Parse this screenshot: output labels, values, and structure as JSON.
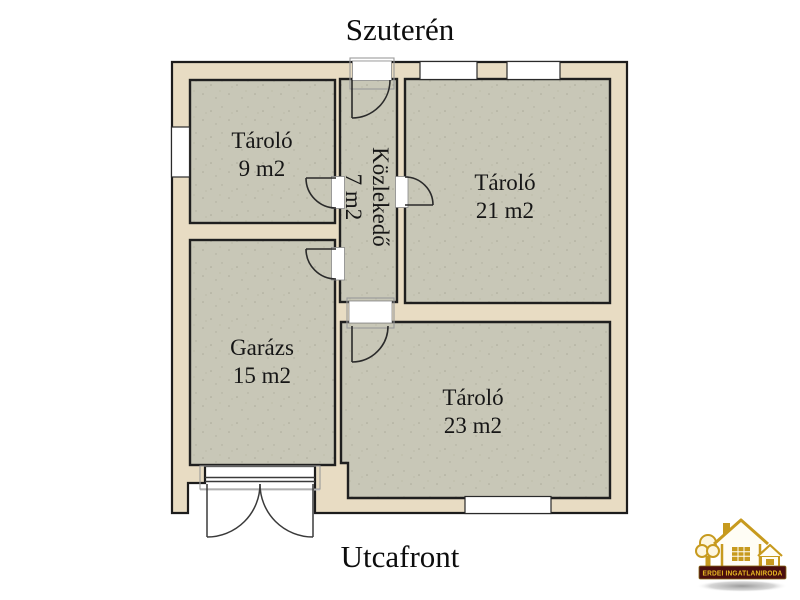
{
  "titles": {
    "top": "Szuterén",
    "bottom": "Utcafront"
  },
  "rooms": [
    {
      "name": "Tároló",
      "area": "9 m2"
    },
    {
      "name": "Közlekedő",
      "area": "7 m2"
    },
    {
      "name": "Tároló",
      "area": "21 m2"
    },
    {
      "name": "Garázs",
      "area": "15 m2"
    },
    {
      "name": "Tároló",
      "area": "23 m2"
    }
  ],
  "logo": {
    "banner": "ERDEI INGATLANIRODA"
  },
  "colors": {
    "wall_fill": "#e8dcc3",
    "room_fill": "#c8c7b7",
    "outline": "#1c1c1c",
    "logo_gold": "#c79a1e",
    "logo_banner_bg": "#4a0e0e",
    "logo_banner_text": "#e8b923"
  }
}
